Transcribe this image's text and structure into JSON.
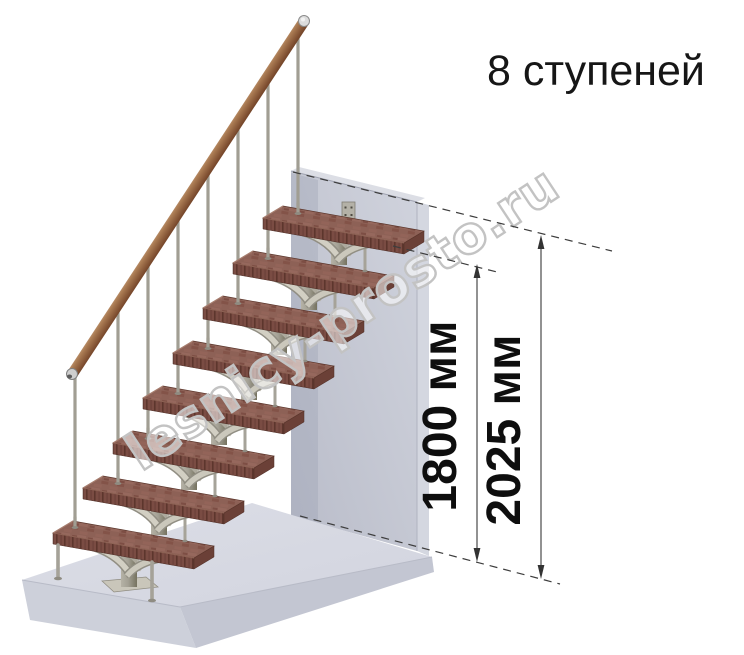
{
  "page": {
    "width": 744,
    "height": 655,
    "background": "#ffffff"
  },
  "header": {
    "title": "8 ступеней",
    "title_color": "#161616"
  },
  "watermark": {
    "text": "lesnicy-prosto.ru",
    "outline_color": "#c3c3c3"
  },
  "dimensions": {
    "items": [
      {
        "id": "stair-height",
        "label": "1800 мм"
      },
      {
        "id": "total-height",
        "label": "2025 мм"
      }
    ],
    "line_color": "#4a4a4a",
    "text_color": "#0e0e0e"
  },
  "scene": {
    "type": "modular-staircase-3d-render",
    "steps_count": 8,
    "colors": {
      "tread_top": "#8d6156",
      "tread_front": "#7a4c43",
      "tread_side": "#6b4037",
      "handrail_wood": "#a97a52",
      "metal_post": "#a19e93",
      "frame_branch": "#d2cfc3",
      "wall": "#c6c9d4",
      "floor": "#d8dae3"
    }
  }
}
